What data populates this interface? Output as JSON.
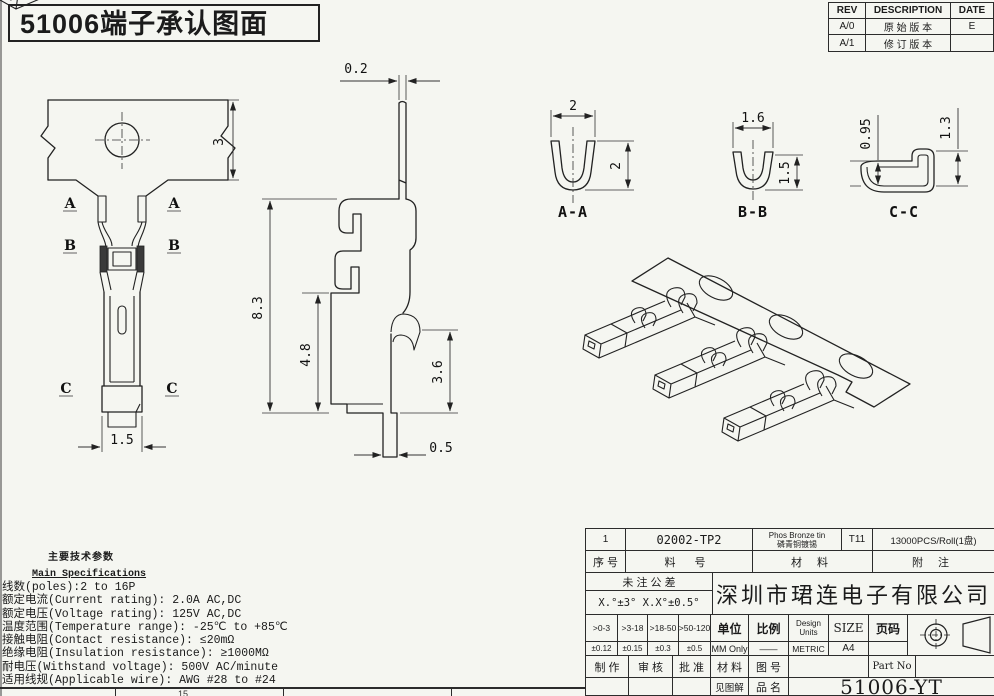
{
  "title": "51006端子承认图面",
  "rev_table": {
    "h_rev": "REV",
    "h_desc": "DESCRIPTION",
    "h_date": "DATE",
    "r1_rev": "A/0",
    "r1_desc": "原 始 版 本",
    "r1_date": "E",
    "r2_rev": "A/1",
    "r2_desc": "修 订 版 本",
    "r2_date": ""
  },
  "front_view": {
    "dim_height": "3",
    "dim_width": "1.5",
    "sec_a": "A",
    "sec_b": "B",
    "sec_c": "C"
  },
  "side_view": {
    "dim_thickness": "0.2",
    "dim_total": "8.3",
    "dim_mid": "4.8",
    "dim_barb": "3.6",
    "dim_tail": "0.5"
  },
  "section_aa": {
    "label": "A-A",
    "dim_w": "2",
    "dim_h": "2"
  },
  "section_bb": {
    "label": "B-B",
    "dim_w": "1.6",
    "dim_h": "1.5"
  },
  "section_cc": {
    "label": "C-C",
    "dim_l": "0.95",
    "dim_r": "1.3"
  },
  "specs": {
    "title_cn": "主要技术参数",
    "title_en": "Main Specifications",
    "lines": [
      "线数(poles):2 to 16P",
      "额定电流(Current rating): 2.0A AC,DC",
      "额定电压(Voltage rating): 125V AC,DC",
      "温度范围(Temperature range): -25℃ to +85℃",
      "接触电阻(Contact resistance): ≤20mΩ",
      "绝缘电阻(Insulation resistance): ≥1000MΩ",
      "耐电压(Withstand voltage): 500V AC/minute",
      "适用线规(Applicable wire): AWG #28 to #24"
    ]
  },
  "title_block": {
    "item_no": "1",
    "part_code": "02002-TP2",
    "material_en": "Phos Bronze tin",
    "material_cn": "磷青铜镀锡",
    "temper": "T11",
    "note_val": "13000PCS/Roll(1盘)",
    "h_item": "序 号",
    "h_part": "料 号",
    "h_material": "材 料",
    "h_note": "附 注",
    "tol_title": "未 注 公 差",
    "tol_angles": "X.°±3° X.X°±0.5°",
    "company": "深圳市珺连电子有限公司",
    "tol_ranges": [
      ">0-3",
      ">3-18",
      ">18-50",
      ">50-120"
    ],
    "tol_values": [
      "±0.12",
      "±0.15",
      "±0.3",
      "±0.5"
    ],
    "h_unit": "单位",
    "unit": "MM Only",
    "h_scale": "比例",
    "scale": "——",
    "h_design_units": "Design",
    "h_design_units2": "Units",
    "design_units": "METRIC",
    "h_size": "SIZE",
    "size": "A4",
    "h_page": "页码",
    "page": "",
    "h_made": "制 作",
    "h_checked": "审 核",
    "h_approved": "批 准",
    "h_material2": "材 料",
    "h_dwg_no": "图 号",
    "h_part_no": "Part No",
    "see_note": "见图解",
    "h_product": "品 名",
    "part_no": "51006-YT"
  },
  "bottom_strip": {
    "cell": "15"
  }
}
